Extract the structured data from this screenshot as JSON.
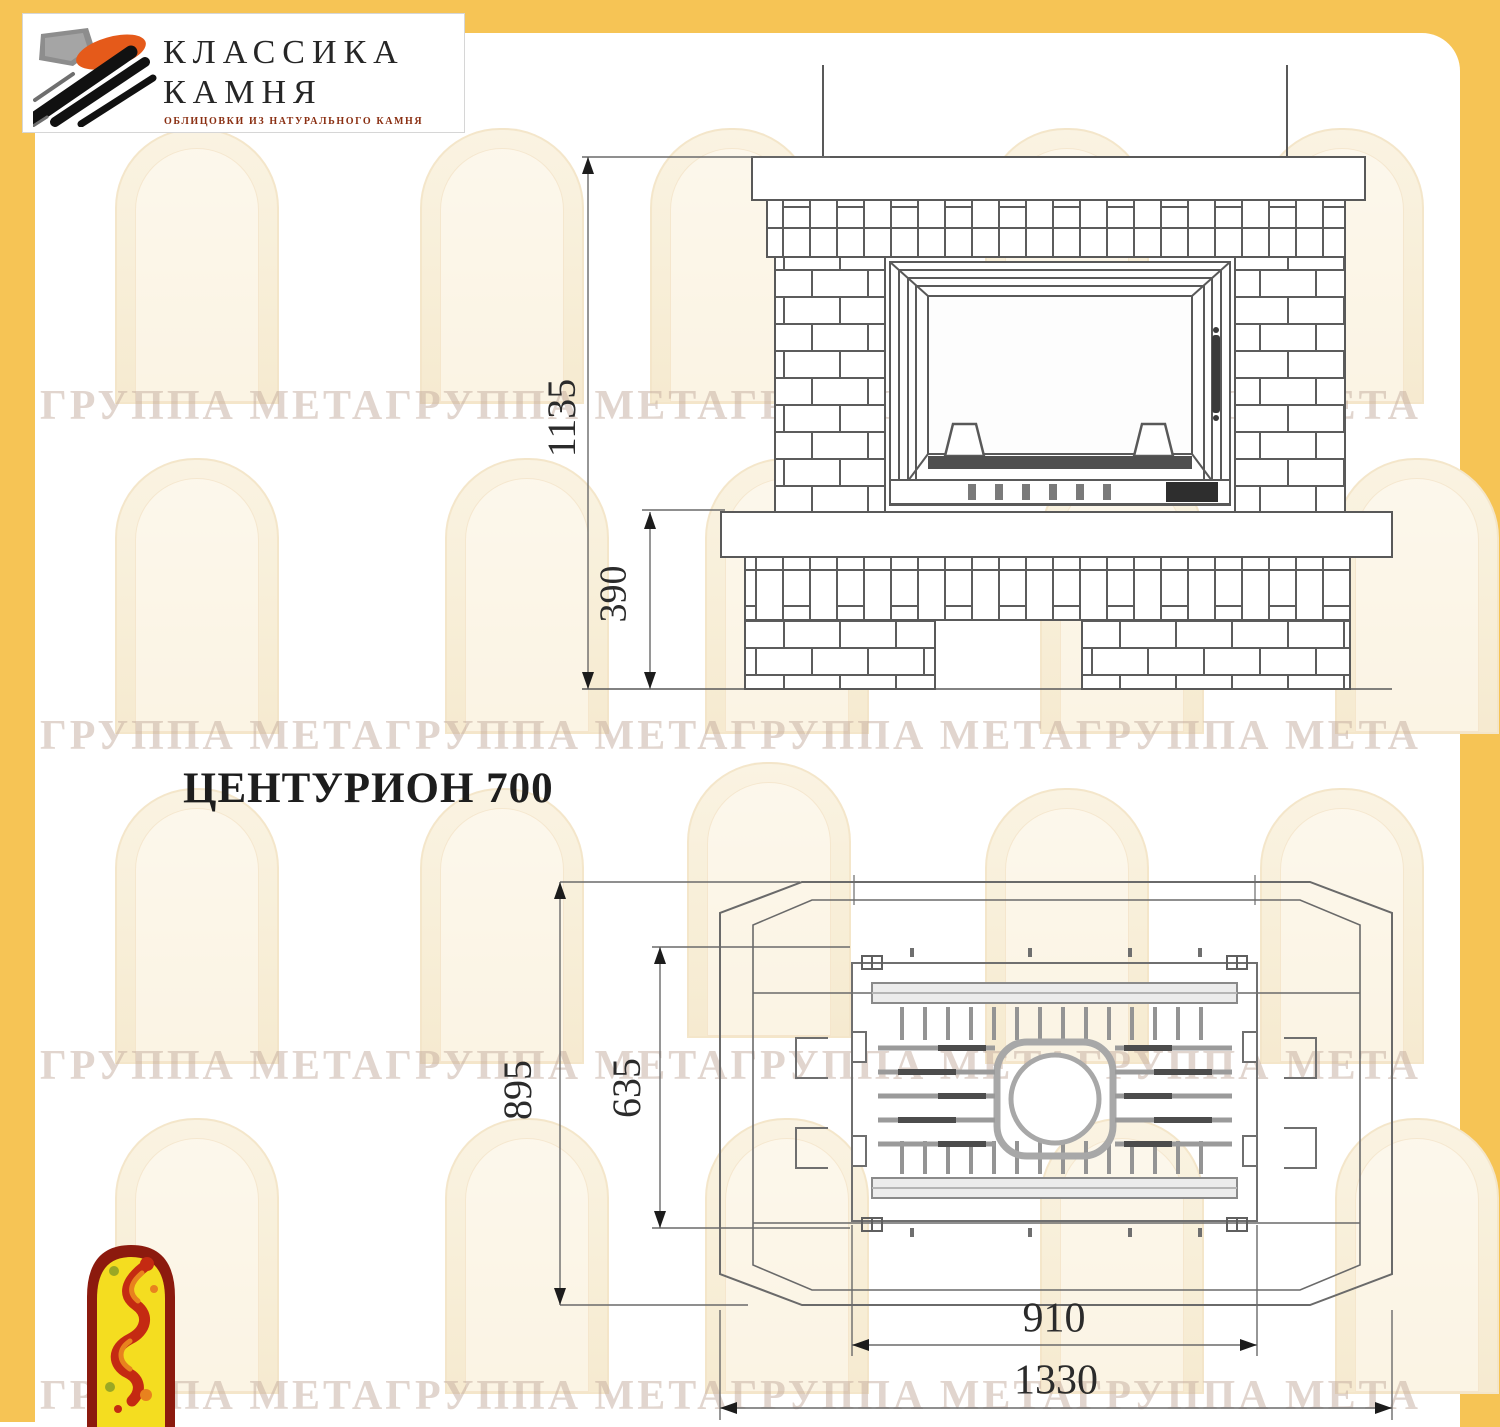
{
  "logo": {
    "line1": "КЛАССИКА",
    "line2": "КАМНЯ",
    "tagline": "ОБЛИЦОВКИ ИЗ НАТУРАЛЬНОГО КАМНЯ"
  },
  "product": {
    "title": "ЦЕНТУРИОН 700"
  },
  "front_view": {
    "dim_total_height": "1135",
    "dim_base_height": "390"
  },
  "plan_view": {
    "dim_total_depth": "895",
    "dim_insert_depth": "635",
    "dim_insert_width": "910",
    "dim_total_width": "1330"
  },
  "watermark": {
    "row_text": "ГРУППА МЕТАГРУППА МЕТАГРУППА МЕТАГРУППА МЕТА"
  },
  "colors": {
    "frame_yellow": "#f6c455",
    "line_gray": "#595959",
    "dim_text": "#2b2b2b",
    "logo_orange": "#e55a1a",
    "emblem_red": "#8c1a0e",
    "emblem_yellow": "#f4dd20"
  }
}
